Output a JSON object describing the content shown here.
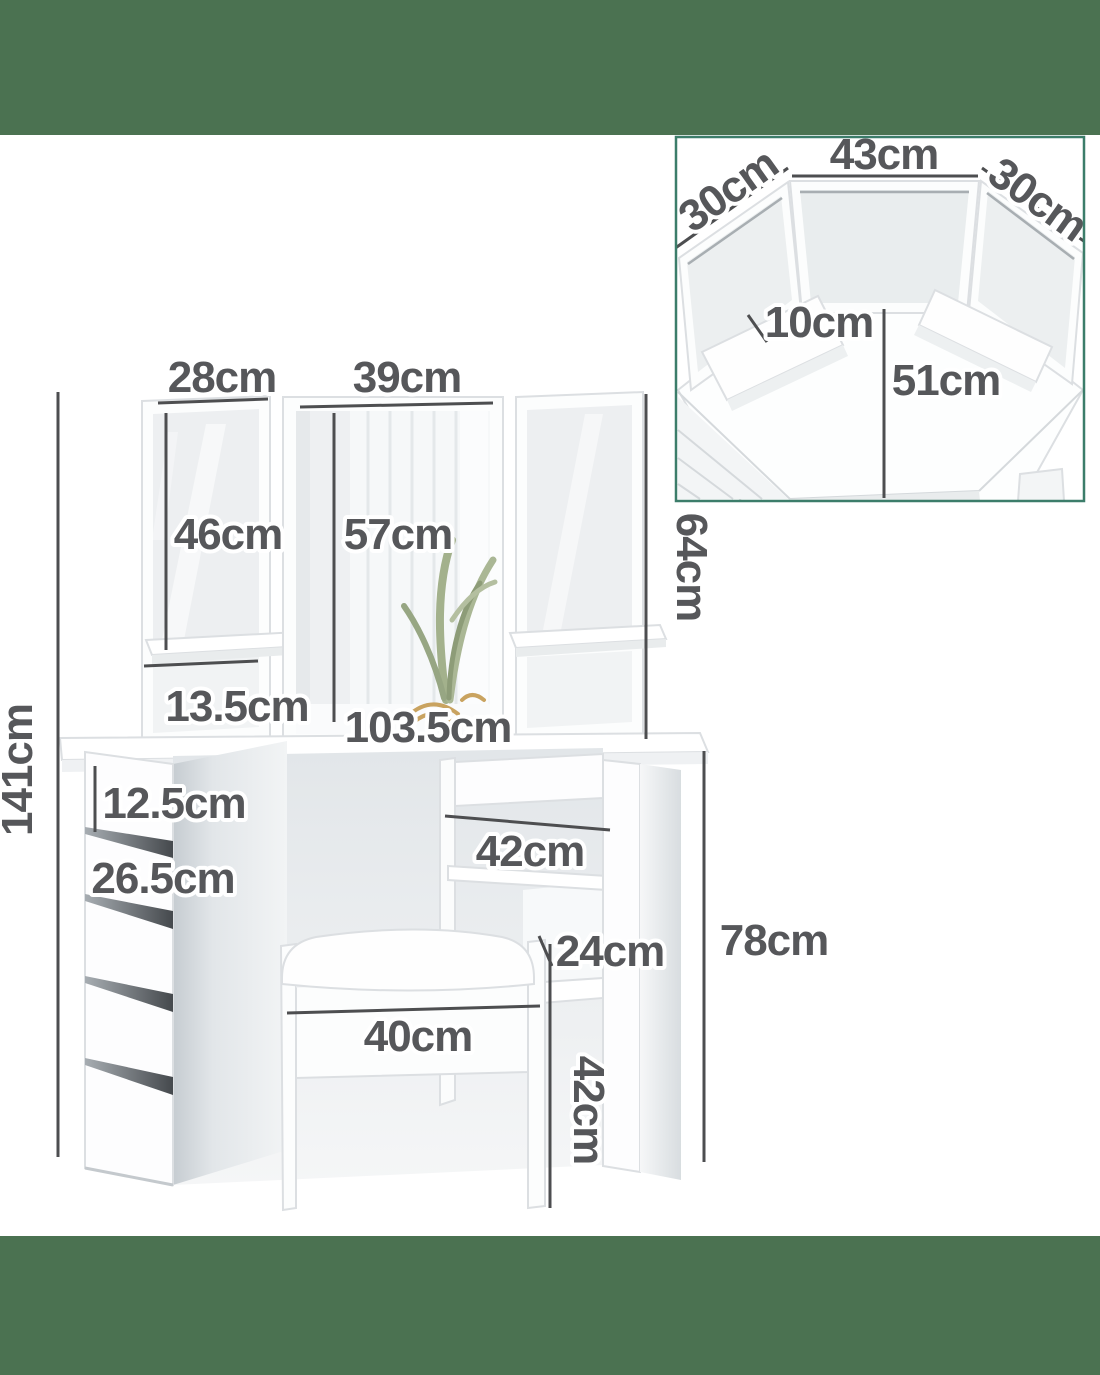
{
  "title": "Corner dressing table dimension diagram",
  "colors": {
    "background": "#ffffff",
    "band_green": "#4b7251",
    "label_gray": "#56575a",
    "dimension_line": "#4d4e50",
    "inset_border_teal": "#3c7d6a",
    "furniture_white": "#fdfdfe",
    "shadow_gray": "#e4e8ea"
  },
  "main_view": {
    "dimensions": {
      "mirror_left_width": "28cm",
      "mirror_center_width": "39cm",
      "mirror_side_height": "46cm",
      "mirror_center_height": "57cm",
      "mirror_total_height": "64cm",
      "side_shelf_depth": "13.5cm",
      "tabletop_width": "103.5cm",
      "overall_height": "141cm",
      "top_drawer_height": "12.5cm",
      "lower_drawer_height": "26.5cm",
      "right_drawer_width": "42cm",
      "knee_clearance_depth": "24cm",
      "tabletop_height": "78cm",
      "stool_width": "40cm",
      "stool_height": "42cm"
    }
  },
  "inset_top_view": {
    "dimensions": {
      "center_mirror_width": "43cm",
      "left_mirror_width": "30cm",
      "right_mirror_width": "30cm",
      "shelf_depth": "10cm",
      "desk_depth": "51cm"
    }
  }
}
